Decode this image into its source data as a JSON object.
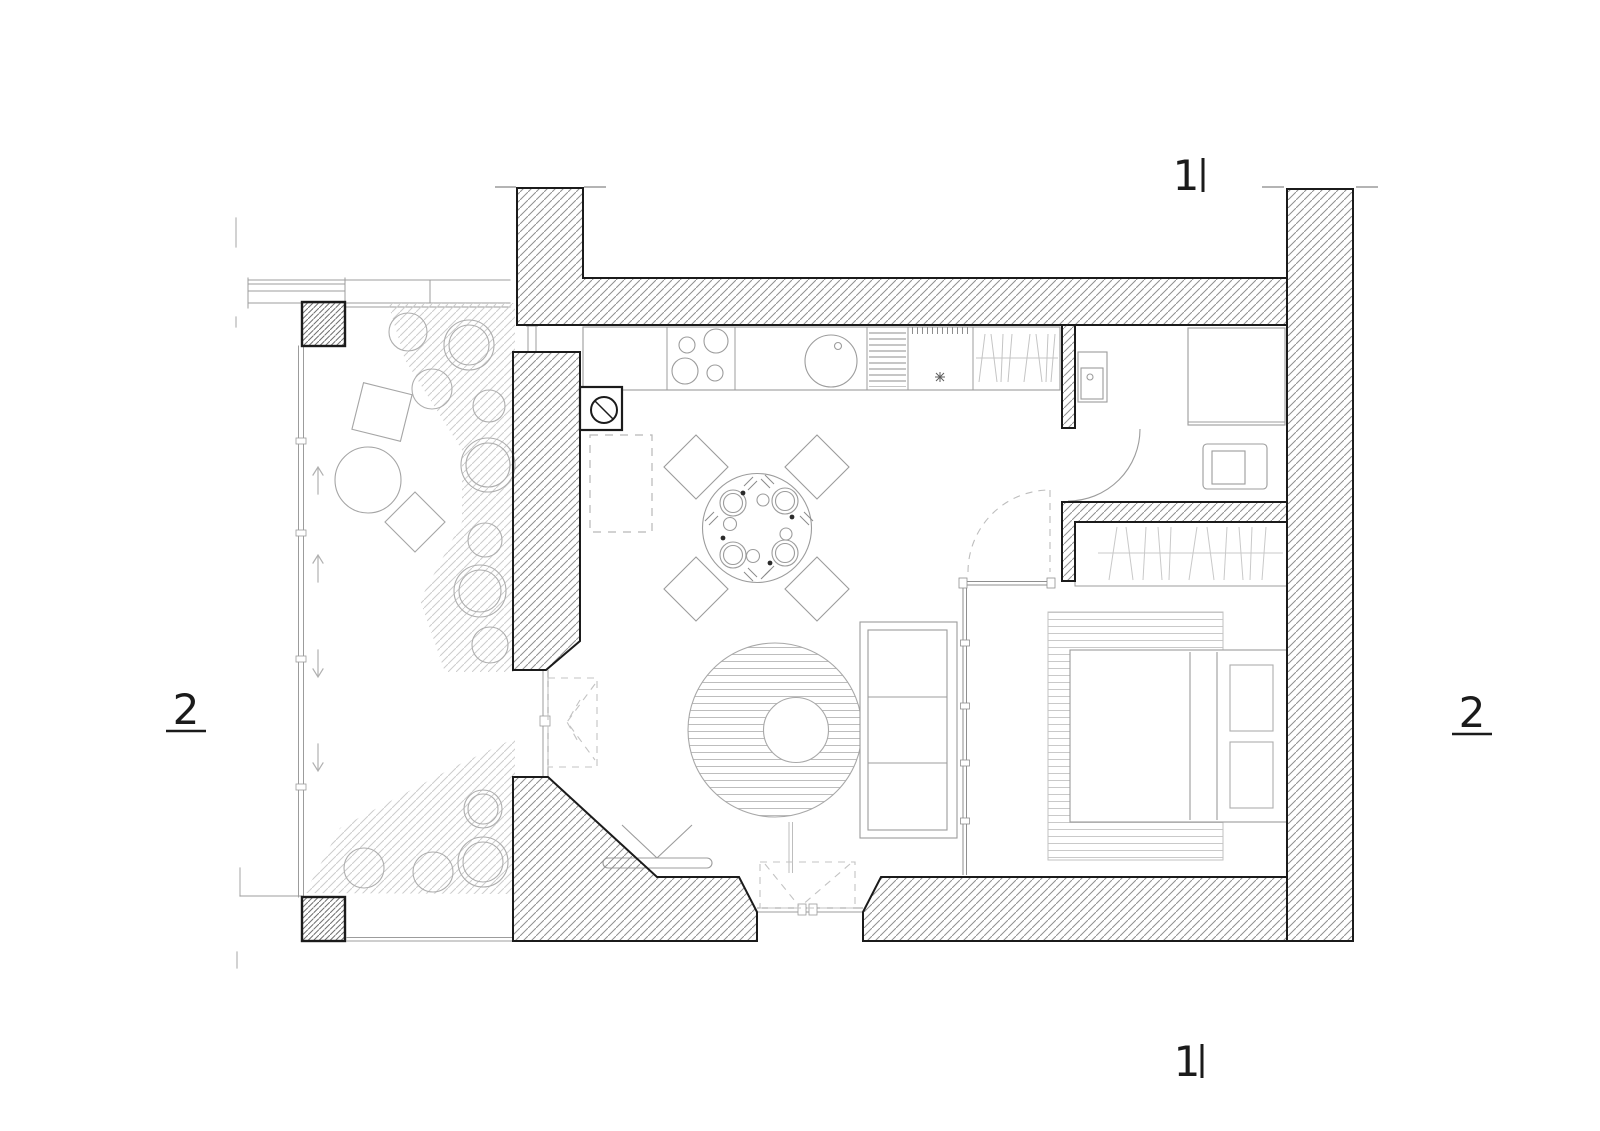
{
  "page": {
    "background": "#ffffff",
    "kind": "apartment floor plan drawing"
  },
  "section_markers": {
    "top": {
      "label": "1"
    },
    "bottom": {
      "label": "1"
    },
    "left": {
      "label": "2"
    },
    "right": {
      "label": "2"
    }
  },
  "palette": {
    "wall_line": "#1b1b1b",
    "wall_hatch": "#8f8f8f",
    "furniture_line": "#9c9c9c",
    "light_line": "#c6c6c6"
  },
  "fixtures": {
    "kitchen": [
      "countertop",
      "cooktop-4-burners",
      "round-sink",
      "dish-drainer",
      "appliance-square",
      "coat-closet"
    ],
    "bathroom": [
      "washbasin",
      "shower",
      "toilet",
      "door-swing"
    ],
    "bedroom": [
      "wardrobe",
      "double-bed",
      "pillows",
      "striped-rug",
      "glass-partition",
      "dashed-door-swing"
    ],
    "living_room": [
      "round-dining-table",
      "four-place-settings",
      "four-chairs",
      "round-striped-rug",
      "coffee-table",
      "sofa",
      "tv",
      "french-door"
    ],
    "balcony": [
      "plants",
      "planting-hatch",
      "round-table",
      "square-table",
      "stool",
      "railing",
      "columns",
      "direction-arrows"
    ]
  }
}
